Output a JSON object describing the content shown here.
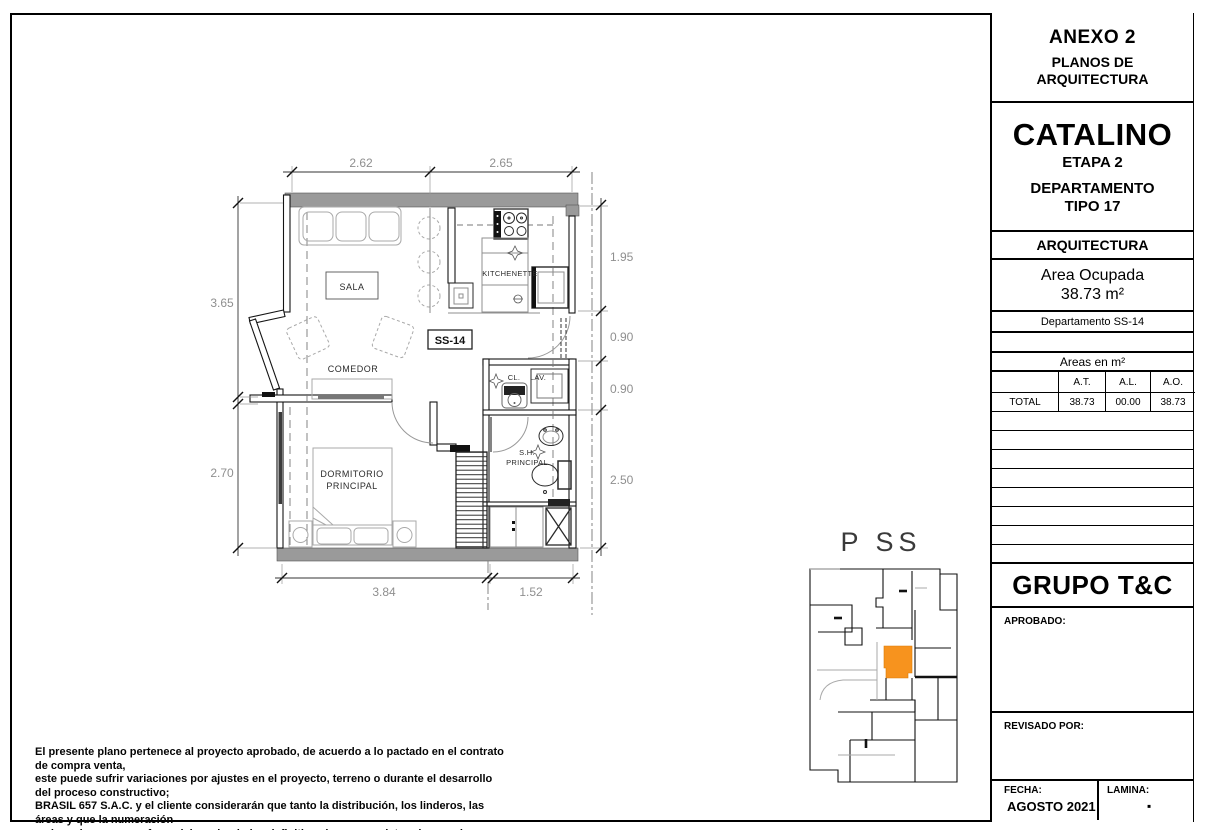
{
  "title_block": {
    "anexo": {
      "title": "ANEXO 2",
      "subtitle_line1": "PLANOS DE",
      "subtitle_line2": "ARQUITECTURA"
    },
    "project": {
      "name": "CATALINO",
      "stage": "ETAPA 2",
      "unit_line1": "DEPARTAMENTO",
      "unit_line2": "TIPO 17"
    },
    "discipline": "ARQUITECTURA",
    "area": {
      "label": "Area Ocupada",
      "value": "38.73 m²"
    },
    "department": "Departamento SS-14",
    "areas_table": {
      "title": "Areas en m²",
      "col_at": "A.T.",
      "col_al": "A.L.",
      "col_ao": "A.O.",
      "row_label": "TOTAL",
      "at": "38.73",
      "al": "00.00",
      "ao": "38.73"
    },
    "company": "GRUPO T&C",
    "approved_label": "APROBADO:",
    "reviewed_label": "REVISADO POR:",
    "date_label": "FECHA:",
    "date_value": "AGOSTO 2021",
    "sheet_label": "LAMINA:",
    "sheet_value": "▪"
  },
  "plan": {
    "unit_label": "SS-14",
    "rooms": {
      "sala": "SALA",
      "comedor": "COMEDOR",
      "kitchenette": "KITCHENETTE",
      "dormitorio_line1": "DORMITORIO",
      "dormitorio_line2": "PRINCIPAL",
      "sh_line1": "S.H.",
      "sh_line2": "PRINCIPAL",
      "closet": "CL.",
      "laundry": "LAV."
    },
    "dimensions": {
      "top": [
        "2.62",
        "2.65"
      ],
      "left": [
        "3.65",
        "2.70"
      ],
      "right": [
        "1.95",
        "0.90",
        "0.90",
        "2.50"
      ],
      "bottom": [
        "3.84",
        "1.52"
      ]
    }
  },
  "key_plan": {
    "title": "P SS",
    "highlight_color": "#F7931E"
  },
  "disclaimer": {
    "lines": [
      "El presente plano pertenece al proyecto aprobado, de acuerdo a lo pactado en el contrato de compra venta,",
      "este puede sufrir variaciones por ajustes en el proyecto, terreno o durante el desarrollo del proceso constructivo;",
      "BRASIL 657 S.A.C. y el cliente considerarán que tanto la distribución, los linderos, las áreas y que la numeración",
      "en los mismos son referenciales, siendo las definitivas las que se determinen en la independización registral."
    ]
  },
  "colors": {
    "wall_gray": "#9a9a9a",
    "dim_text": "#8f8f8f",
    "highlight": "#F7931E"
  }
}
